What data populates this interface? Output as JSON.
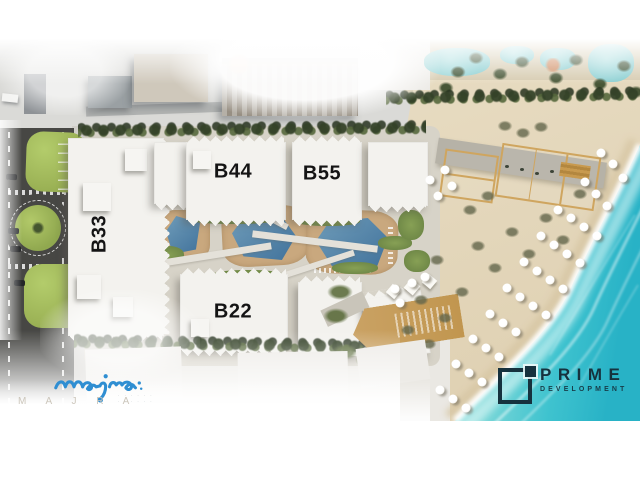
{
  "branding": {
    "majra": {
      "script_text": "majra",
      "wordmark": "M A J R A",
      "tagline_line1": "· · · · · ·",
      "tagline_line2": "· · · · · ·"
    },
    "prime": {
      "name": "PRIME",
      "subtitle": "DEVELOPMENT"
    }
  },
  "site_plan": {
    "building_labels": [
      {
        "id": "b33",
        "label": "B33",
        "x": 100,
        "y": 234,
        "rotated": true
      },
      {
        "id": "b44",
        "label": "B44",
        "x": 233,
        "y": 172,
        "rotated": false
      },
      {
        "id": "b55",
        "label": "B55",
        "x": 322,
        "y": 174,
        "rotated": false
      },
      {
        "id": "b22",
        "label": "B22",
        "x": 233,
        "y": 312,
        "rotated": false
      }
    ],
    "umbrellas": [
      [
        601,
        153
      ],
      [
        613,
        164
      ],
      [
        623,
        178
      ],
      [
        585,
        182
      ],
      [
        596,
        194
      ],
      [
        607,
        206
      ],
      [
        558,
        210
      ],
      [
        571,
        218
      ],
      [
        584,
        227
      ],
      [
        597,
        236
      ],
      [
        541,
        236
      ],
      [
        554,
        245
      ],
      [
        567,
        254
      ],
      [
        580,
        263
      ],
      [
        524,
        262
      ],
      [
        537,
        271
      ],
      [
        550,
        280
      ],
      [
        563,
        289
      ],
      [
        507,
        288
      ],
      [
        520,
        297
      ],
      [
        533,
        306
      ],
      [
        546,
        315
      ],
      [
        490,
        314
      ],
      [
        503,
        323
      ],
      [
        516,
        332
      ],
      [
        473,
        339
      ],
      [
        486,
        348
      ],
      [
        499,
        357
      ],
      [
        456,
        364
      ],
      [
        469,
        373
      ],
      [
        482,
        382
      ],
      [
        440,
        390
      ],
      [
        453,
        399
      ],
      [
        466,
        408
      ],
      [
        445,
        170
      ],
      [
        430,
        180
      ],
      [
        452,
        186
      ],
      [
        438,
        196
      ],
      [
        395,
        289
      ],
      [
        412,
        283
      ],
      [
        400,
        303
      ],
      [
        425,
        277
      ]
    ],
    "beach_bushes": [
      [
        478,
        246
      ],
      [
        512,
        232
      ],
      [
        546,
        218
      ],
      [
        580,
        194
      ],
      [
        462,
        292
      ],
      [
        445,
        318
      ],
      [
        495,
        268
      ],
      [
        529,
        254
      ],
      [
        429,
        344
      ],
      [
        418,
        372
      ],
      [
        563,
        240
      ],
      [
        421,
        300
      ],
      [
        408,
        330
      ],
      [
        437,
        260
      ],
      [
        505,
        126
      ],
      [
        523,
        133
      ],
      [
        541,
        127
      ],
      [
        470,
        210
      ],
      [
        488,
        196
      ]
    ],
    "shrubs": [
      [
        345,
        352
      ],
      [
        368,
        360
      ],
      [
        392,
        366
      ],
      [
        416,
        369
      ],
      [
        340,
        292
      ],
      [
        336,
        316
      ]
    ],
    "palm_trees": [
      [
        458,
        72
      ],
      [
        476,
        58
      ],
      [
        500,
        74
      ],
      [
        522,
        62
      ],
      [
        556,
        78
      ],
      [
        576,
        60
      ],
      [
        600,
        84
      ],
      [
        624,
        66
      ],
      [
        636,
        92
      ],
      [
        446,
        88
      ]
    ],
    "colors": {
      "sea-shallow": "#9fe0df",
      "sea-deep": "#28b2c6",
      "sand": "#e3d6ba",
      "pool": "#4b7ba1",
      "deck": "#c9a87e",
      "lawn": "#a3bb5d",
      "road": "#474744",
      "tree": "#3c4e30",
      "majra-blue": "#2f8ed2",
      "prime-navy": "#16323e",
      "label-ink": "#141414"
    }
  }
}
